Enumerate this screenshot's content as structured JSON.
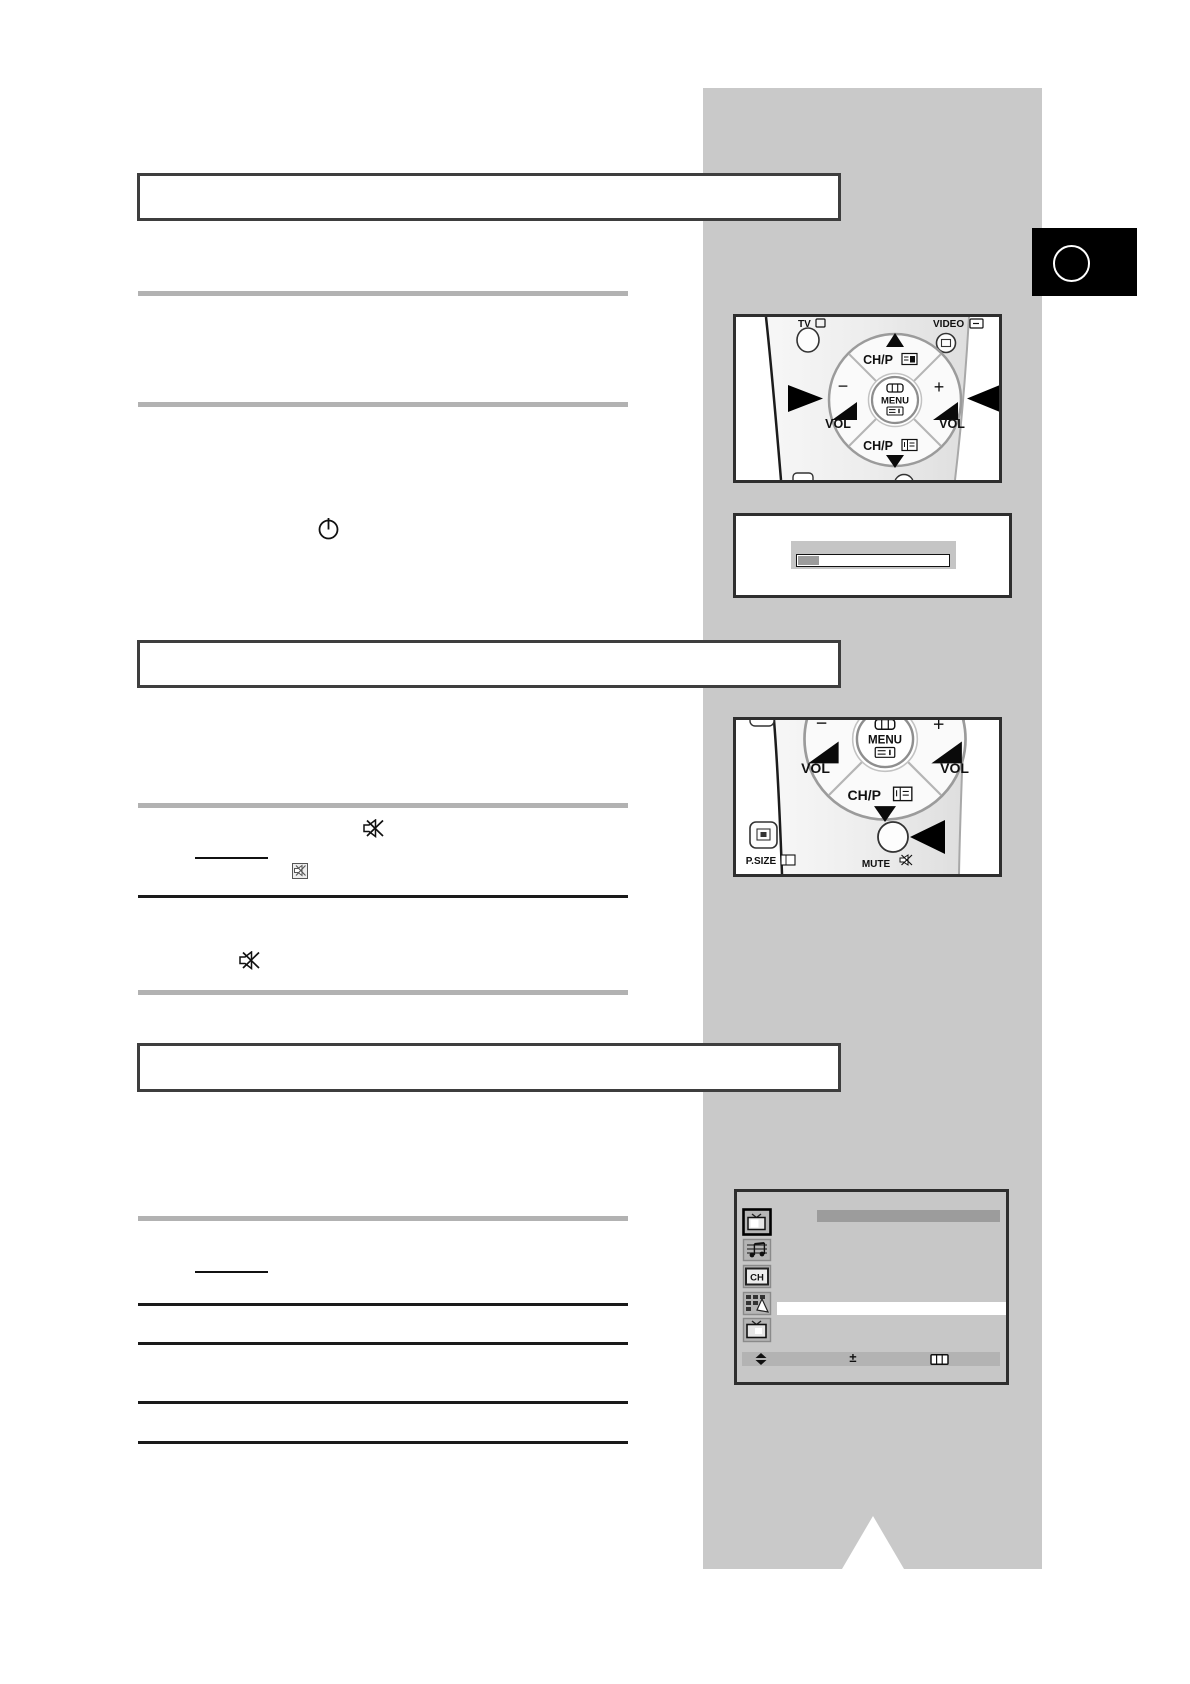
{
  "colors": {
    "band_gray": "#c9c9c9",
    "separator_gray": "#b2b2b2",
    "separator_black": "#1a1a1a",
    "box_border": "#3e3e3e",
    "osd_background": "#c7c7c7",
    "osd_titlebar": "#9c9c9c",
    "osd_navbar": "#b3b3b3",
    "volume_fill": "#9b9b9b"
  },
  "remote_top": {
    "tv": "TV",
    "video": "VIDEO",
    "chp_up": "CH/P",
    "chp_down": "CH/P",
    "menu": "MENU",
    "vol_minus": "VOL",
    "vol_plus": "VOL",
    "minus": "−",
    "plus": "+"
  },
  "remote_bottom": {
    "menu": "MENU",
    "chp_down": "CH/P",
    "vol_minus": "VOL",
    "vol_plus": "VOL",
    "minus": "−",
    "plus": "+",
    "psize": "P.SIZE",
    "mute": "MUTE"
  },
  "menu_osd": {
    "ch_icon_text": "CH",
    "nav_adjust": "±",
    "icons": [
      "tv-icon",
      "sound-icon",
      "channel-icon",
      "channel-edit-icon",
      "tv-setup-icon"
    ]
  },
  "symbols": {
    "power": "standby-power-icon",
    "mute": "mute-speaker-icon"
  }
}
